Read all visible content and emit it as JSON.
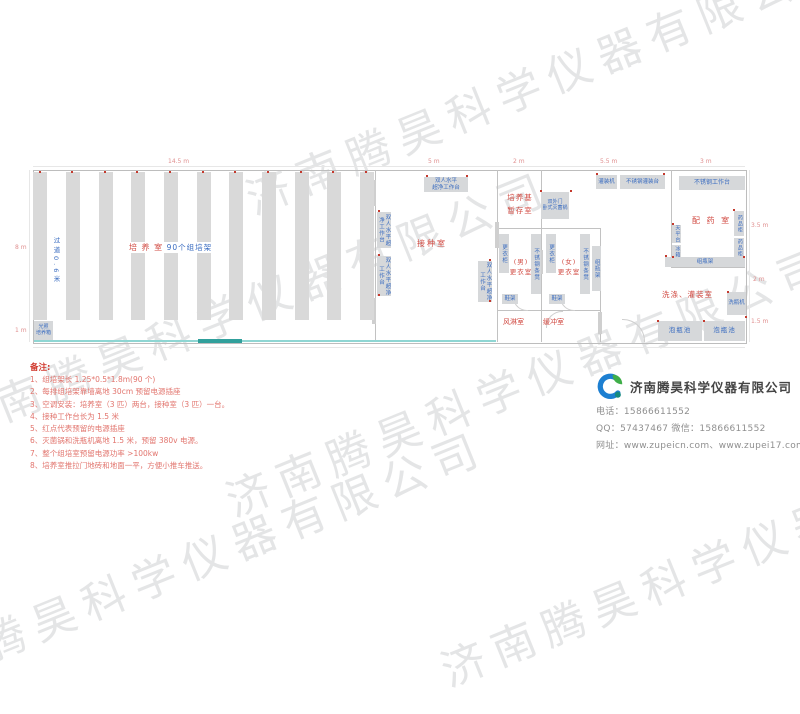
{
  "watermark": {
    "text": "济南腾昊科学仪器有限公司"
  },
  "plan": {
    "dims": {
      "top_culture": "14.5 m",
      "top_inoculation": "5 m",
      "top_corridor": "2 m",
      "top_middle": "5.5 m",
      "top_pharmacy": "3 m",
      "left_main": "8 m",
      "left_front": "1 m",
      "right_pharmacy": "3.5 m",
      "right_washing": "2 m",
      "right_pool": "1.5 m"
    },
    "culture_room": {
      "name": "培 养 室",
      "racks_label": "90个组培架",
      "aisle_label": "过道0.6米",
      "incubator_line1": "光照",
      "incubator_line2": "培养箱"
    },
    "inoculation_room": {
      "name": "接种室",
      "bench_line1": "双人水平",
      "bench_line2": "超净工作台",
      "bench_vertical": "双人水平超净工作台"
    },
    "medium_room": {
      "name_line1": "培养基",
      "name_line2": "暂存室",
      "autoclave_line1": "双外门",
      "autoclave_line2": "卧式灭菌锅"
    },
    "changing_area": {
      "male_line1": "(男)",
      "male_line2": "更衣室",
      "female_line1": "(女)",
      "female_line2": "更衣室",
      "wardrobe": "更衣柜",
      "steel_bench": "不锈钢条凳",
      "bottle_rack": "组瓶架",
      "shoe_rack": "鞋架",
      "air_shower": "风淋室",
      "buffer_room": "缓冲室"
    },
    "pharmacy_room": {
      "name": "配 药 室",
      "worktable": "不锈钢工作台",
      "balance_table": "天平台",
      "fridge": "冰箱",
      "medicine_cabinet": "药品柜",
      "bottle_rack": "组瓶架"
    },
    "washing_room": {
      "name": "洗涤、灌装室",
      "filling_machine": "灌装机",
      "filling_table": "不锈钢灌装台",
      "bottle_washer": "洗瓶机",
      "soaking_pool": "泡瓶池"
    }
  },
  "notes": {
    "title": "备注:",
    "items": [
      "1、组培架长 1.25*0.5*1.8m(90 个)",
      "2、每排组培架靠墙离地 30cm 预留电源插座",
      "3、空调安装：培养室（3 匹）两台，接种室（3 匹）一台。",
      "4、接种工作台长为 1.5 米",
      "5、红点代表预留的电源插座",
      "6、灭菌锅和洗瓶机离地 1.5 米，预留 380v 电源。",
      "7、整个组培室预留电源功率 >100kw",
      "8、培养室推拉门地砖和地面一平，方便小推车推送。"
    ]
  },
  "company": {
    "name": "济南腾昊科学仪器有限公司",
    "phone_line": "电话：15866611552",
    "qq_line": "QQ：57437467   微信：15866611552",
    "web_line": "网址：www.zupeicn.com、www.zupei17.com"
  }
}
